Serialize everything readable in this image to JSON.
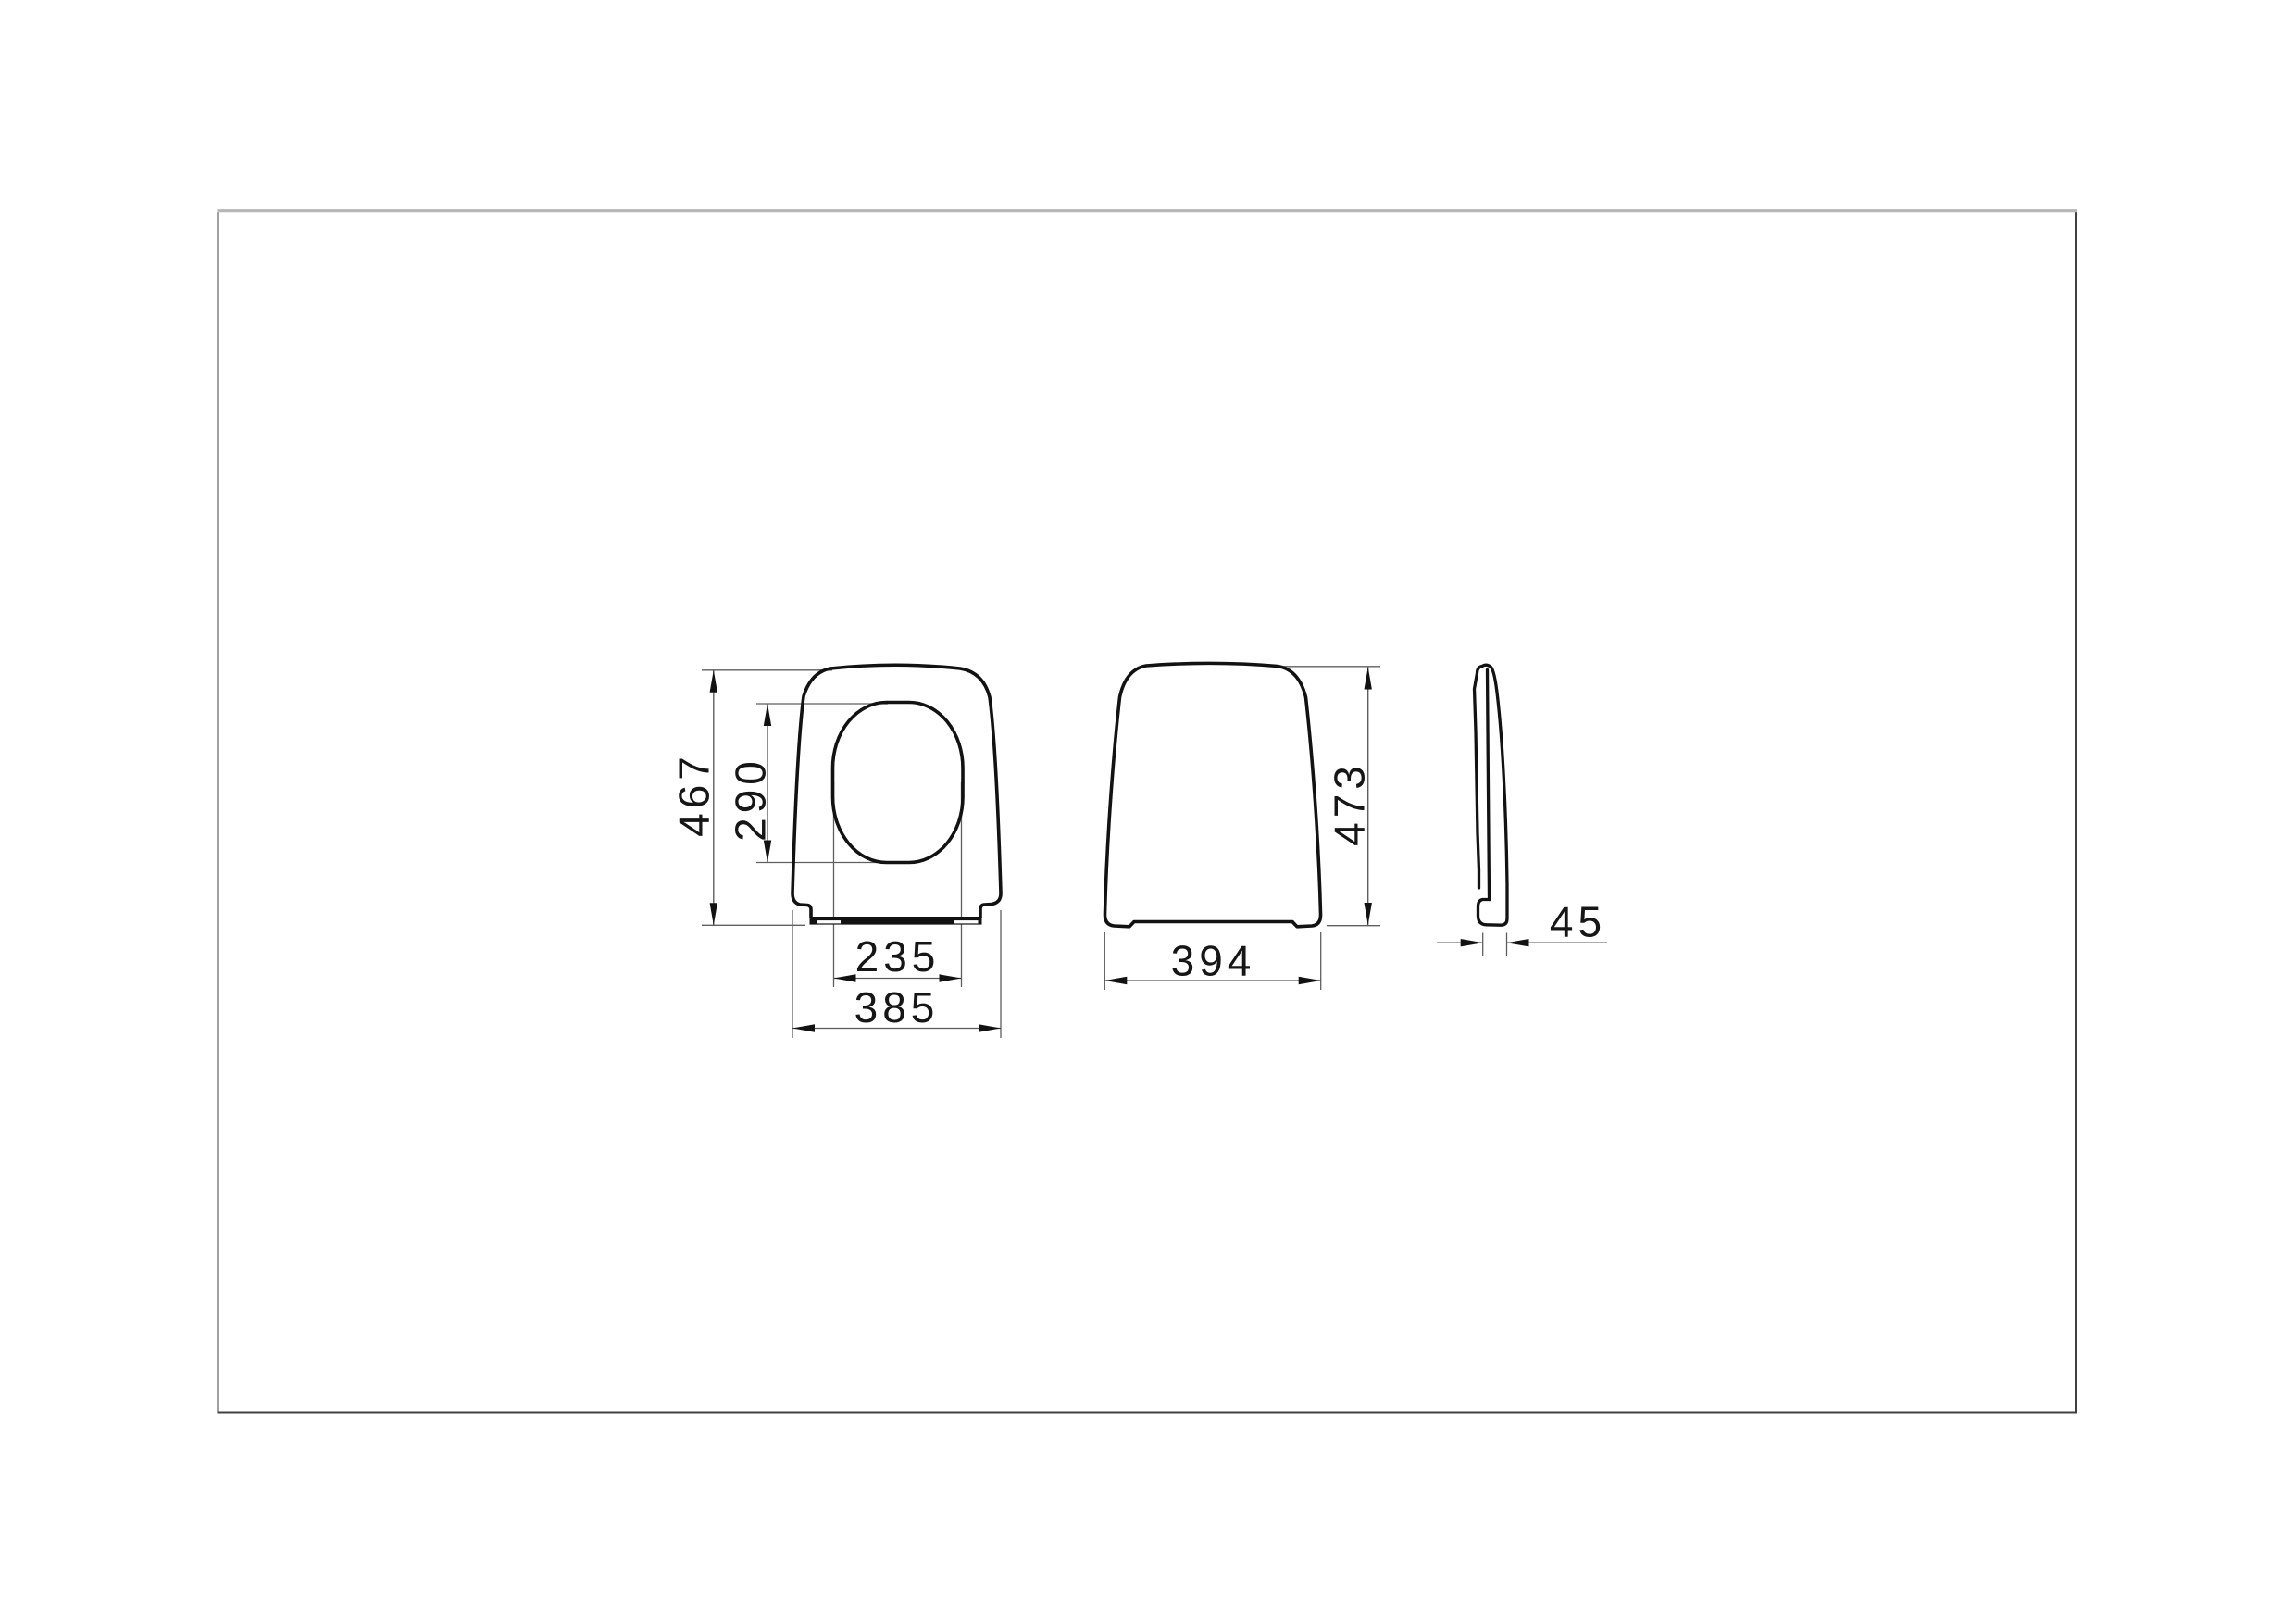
{
  "drawing": {
    "description_present": false,
    "dimensions": {
      "seat_top_view": {
        "overall_length_mm": "467",
        "hole_length_mm": "290",
        "hole_width_mm": "235",
        "overall_width_mm": "385"
      },
      "cover_top_view": {
        "overall_width_mm": "394",
        "overall_length_mm": "473"
      },
      "side_view": {
        "thickness_mm": "45"
      }
    },
    "colors": {
      "outline": "#121212",
      "dimension_line": "#5a5a5a",
      "text": "#161616",
      "frame_border": "#404040",
      "frame_border_top": "#b7b7b7",
      "background": "#ffffff"
    }
  }
}
